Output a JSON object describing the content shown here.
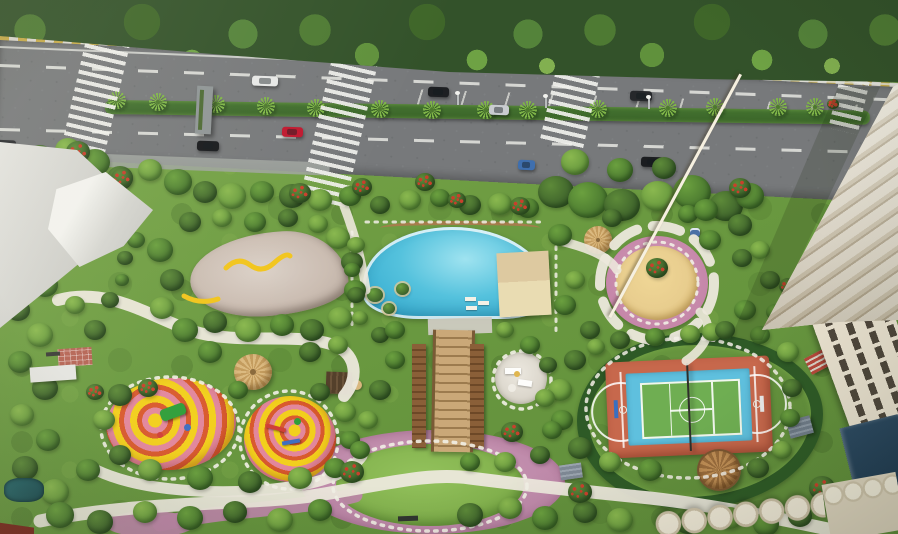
{
  "meta": {
    "title": "Aerial 3D masterplan render of residential amenity podium",
    "render_type": "architectural-visualization",
    "visible_text": "none"
  },
  "palette": {
    "canopy_base": "#33522a",
    "canopy_leaf": "#5d8a39",
    "road": "#77797b",
    "road_dark": "#646768",
    "lane_white": "#e6e7e2",
    "curb_yellow": "#d2b245",
    "median_green": "#3a6429",
    "palm_green": "#7fb548",
    "garden_light": "#79a649",
    "garden_dark": "#5f8c3a",
    "hedge_dark": "#2e5a26",
    "path_white": "#ece8dc",
    "pink_pave": "#bd87a8",
    "pool_light": "#9fe3f0",
    "pool_mid": "#55c2dd",
    "pool_deep": "#2ba4cb",
    "deck_cream": "#e9dcb2",
    "sand": "#e8cd8e",
    "swirl_yellow": "#f2cf1d",
    "swirl_pink": "#e2879c",
    "swirl_orange": "#d95a2e",
    "court_red": "#c7684c",
    "court_blue": "#5fc0de",
    "court_green": "#6fae52",
    "tower_light": "#f3edde",
    "tower_mid": "#d9cfb8",
    "tower_shadow": "#b9ac92",
    "glass_dark": "#1f3a52",
    "thatch": "#b5854f",
    "lawn": "#7fae4a",
    "flower_red": "#c8402c"
  },
  "scene": {
    "amenities": [
      "access-road",
      "palm-median",
      "zebra-crossings",
      "swimming-pool",
      "pool-deck",
      "skate-pad",
      "sand-play-circle",
      "kids-playground-swirl",
      "grand-staircase",
      "outdoor-lounge",
      "central-lawn",
      "pink-plaza",
      "multi-sport-court",
      "thatched-gazebo",
      "residential-tower",
      "entrance-plaza"
    ],
    "tree_shades": [
      [
        "#3b5f2a",
        "#5d8a39"
      ],
      [
        "#47752e",
        "#6ba03f"
      ],
      [
        "#63953c",
        "#8ab84f"
      ],
      [
        "#83b24e",
        "#a8cd6b"
      ]
    ],
    "trees": [
      [
        15,
        170,
        16,
        1
      ],
      [
        40,
        158,
        14,
        0
      ],
      [
        68,
        150,
        13,
        2
      ],
      [
        95,
        162,
        15,
        1
      ],
      [
        120,
        178,
        13,
        0
      ],
      [
        150,
        170,
        12,
        2
      ],
      [
        178,
        182,
        14,
        1
      ],
      [
        205,
        192,
        12,
        0
      ],
      [
        232,
        196,
        14,
        2
      ],
      [
        262,
        192,
        12,
        1
      ],
      [
        292,
        196,
        13,
        0
      ],
      [
        320,
        200,
        12,
        2
      ],
      [
        350,
        196,
        11,
        1
      ],
      [
        380,
        205,
        10,
        0
      ],
      [
        410,
        200,
        11,
        2
      ],
      [
        440,
        198,
        10,
        1
      ],
      [
        470,
        205,
        11,
        0
      ],
      [
        500,
        204,
        12,
        2
      ],
      [
        528,
        208,
        11,
        1
      ],
      [
        556,
        192,
        18,
        0
      ],
      [
        588,
        200,
        20,
        1
      ],
      [
        622,
        205,
        18,
        0
      ],
      [
        658,
        196,
        17,
        2
      ],
      [
        692,
        192,
        19,
        1
      ],
      [
        726,
        206,
        17,
        0
      ],
      [
        750,
        196,
        14,
        1
      ],
      [
        575,
        162,
        14,
        2
      ],
      [
        620,
        170,
        13,
        1
      ],
      [
        664,
        168,
        12,
        0
      ],
      [
        18,
        225,
        13,
        1
      ],
      [
        42,
        238,
        12,
        0
      ],
      [
        20,
        262,
        12,
        2
      ],
      [
        45,
        285,
        13,
        1
      ],
      [
        18,
        310,
        12,
        0
      ],
      [
        40,
        335,
        13,
        2
      ],
      [
        20,
        362,
        12,
        1
      ],
      [
        45,
        388,
        13,
        0
      ],
      [
        22,
        415,
        12,
        2
      ],
      [
        48,
        440,
        12,
        1
      ],
      [
        25,
        468,
        13,
        0
      ],
      [
        55,
        492,
        14,
        2
      ],
      [
        88,
        470,
        12,
        1
      ],
      [
        95,
        330,
        11,
        0
      ],
      [
        75,
        305,
        10,
        2
      ],
      [
        110,
        300,
        9,
        0
      ],
      [
        125,
        258,
        8,
        0
      ],
      [
        136,
        240,
        9,
        1
      ],
      [
        118,
        238,
        7,
        0
      ],
      [
        122,
        280,
        7,
        1
      ],
      [
        160,
        250,
        13,
        1
      ],
      [
        172,
        280,
        12,
        0
      ],
      [
        162,
        308,
        12,
        2
      ],
      [
        185,
        330,
        13,
        1
      ],
      [
        215,
        322,
        12,
        0
      ],
      [
        248,
        330,
        13,
        2
      ],
      [
        282,
        325,
        12,
        1
      ],
      [
        312,
        330,
        12,
        0
      ],
      [
        340,
        318,
        12,
        2
      ],
      [
        355,
        290,
        11,
        1
      ],
      [
        352,
        262,
        11,
        0
      ],
      [
        338,
        238,
        12,
        2
      ],
      [
        210,
        352,
        12,
        1
      ],
      [
        310,
        352,
        11,
        0
      ],
      [
        338,
        345,
        10,
        2
      ],
      [
        190,
        222,
        11,
        0
      ],
      [
        222,
        218,
        10,
        2
      ],
      [
        255,
        222,
        11,
        1
      ],
      [
        288,
        218,
        10,
        0
      ],
      [
        318,
        224,
        10,
        2
      ],
      [
        120,
        395,
        12,
        0
      ],
      [
        104,
        420,
        11,
        2
      ],
      [
        238,
        390,
        10,
        1
      ],
      [
        320,
        392,
        10,
        0
      ],
      [
        345,
        412,
        11,
        2
      ],
      [
        350,
        440,
        10,
        1
      ],
      [
        120,
        455,
        11,
        0
      ],
      [
        150,
        470,
        12,
        2
      ],
      [
        200,
        478,
        13,
        1
      ],
      [
        250,
        482,
        12,
        0
      ],
      [
        300,
        478,
        12,
        2
      ],
      [
        335,
        468,
        11,
        1
      ],
      [
        60,
        515,
        14,
        1
      ],
      [
        100,
        522,
        13,
        0
      ],
      [
        145,
        512,
        12,
        2
      ],
      [
        190,
        518,
        13,
        1
      ],
      [
        235,
        512,
        12,
        0
      ],
      [
        280,
        520,
        13,
        2
      ],
      [
        320,
        510,
        12,
        1
      ],
      [
        470,
        515,
        13,
        0
      ],
      [
        510,
        508,
        12,
        2
      ],
      [
        545,
        518,
        13,
        1
      ],
      [
        585,
        512,
        12,
        0
      ],
      [
        620,
        520,
        13,
        2
      ],
      [
        688,
        522,
        13,
        0
      ],
      [
        730,
        518,
        12,
        2
      ],
      [
        766,
        524,
        13,
        1
      ],
      [
        800,
        516,
        12,
        0
      ],
      [
        356,
        245,
        9,
        2
      ],
      [
        352,
        270,
        8,
        1
      ],
      [
        356,
        295,
        9,
        0
      ],
      [
        360,
        318,
        8,
        2
      ],
      [
        380,
        335,
        9,
        0
      ],
      [
        395,
        330,
        10,
        1
      ],
      [
        560,
        235,
        12,
        1
      ],
      [
        575,
        280,
        10,
        2
      ],
      [
        565,
        305,
        11,
        1
      ],
      [
        590,
        330,
        10,
        0
      ],
      [
        710,
        240,
        11,
        1
      ],
      [
        740,
        225,
        12,
        0
      ],
      [
        712,
        332,
        10,
        2
      ],
      [
        745,
        310,
        11,
        1
      ],
      [
        770,
        280,
        10,
        0
      ],
      [
        760,
        250,
        10,
        2
      ],
      [
        612,
        218,
        10,
        0
      ],
      [
        688,
        214,
        10,
        1
      ],
      [
        575,
        360,
        11,
        0
      ],
      [
        560,
        390,
        12,
        2
      ],
      [
        562,
        420,
        11,
        1
      ],
      [
        580,
        448,
        12,
        0
      ],
      [
        610,
        462,
        11,
        2
      ],
      [
        650,
        470,
        12,
        1
      ],
      [
        758,
        468,
        11,
        0
      ],
      [
        782,
        450,
        10,
        2
      ],
      [
        790,
        418,
        10,
        1
      ],
      [
        792,
        388,
        10,
        0
      ],
      [
        788,
        352,
        11,
        2
      ],
      [
        760,
        335,
        10,
        1
      ],
      [
        725,
        330,
        10,
        0
      ],
      [
        690,
        334,
        10,
        2
      ],
      [
        655,
        337,
        10,
        1
      ],
      [
        620,
        340,
        10,
        0
      ],
      [
        596,
        347,
        9,
        2
      ],
      [
        395,
        360,
        10,
        1
      ],
      [
        380,
        390,
        11,
        0
      ],
      [
        368,
        420,
        10,
        2
      ],
      [
        360,
        450,
        10,
        1
      ],
      [
        505,
        330,
        9,
        2
      ],
      [
        530,
        345,
        10,
        1
      ],
      [
        548,
        365,
        9,
        0
      ],
      [
        545,
        398,
        10,
        2
      ],
      [
        552,
        430,
        10,
        1
      ],
      [
        540,
        455,
        10,
        0
      ],
      [
        505,
        462,
        11,
        2
      ],
      [
        470,
        462,
        10,
        1
      ],
      [
        706,
        210,
        12,
        1
      ],
      [
        742,
        258,
        10,
        0
      ],
      [
        775,
        312,
        9,
        1
      ]
    ],
    "flower_trees": [
      [
        32,
        165,
        13
      ],
      [
        78,
        152,
        12
      ],
      [
        122,
        178,
        11
      ],
      [
        300,
        193,
        11
      ],
      [
        362,
        187,
        10
      ],
      [
        425,
        182,
        10
      ],
      [
        457,
        200,
        9
      ],
      [
        520,
        206,
        10
      ],
      [
        740,
        188,
        11
      ],
      [
        352,
        472,
        12
      ],
      [
        512,
        432,
        11
      ],
      [
        580,
        492,
        12
      ],
      [
        822,
        488,
        13
      ],
      [
        148,
        388,
        10
      ],
      [
        788,
        286,
        9
      ],
      [
        95,
        392,
        9
      ],
      [
        833,
        104,
        6
      ],
      [
        657,
        268,
        11
      ]
    ],
    "median_palms": [
      [
        117,
        100
      ],
      [
        158,
        102
      ],
      [
        216,
        104
      ],
      [
        266,
        106
      ],
      [
        316,
        108
      ],
      [
        380,
        109
      ],
      [
        432,
        110
      ],
      [
        486,
        110
      ],
      [
        528,
        110
      ],
      [
        598,
        109
      ],
      [
        668,
        108
      ],
      [
        715,
        107
      ],
      [
        778,
        107
      ],
      [
        815,
        107
      ]
    ],
    "canopy_palms": [
      [
        95,
        14
      ],
      [
        300,
        10
      ],
      [
        498,
        18
      ],
      [
        640,
        6
      ],
      [
        760,
        30
      ],
      [
        843,
        52
      ]
    ],
    "cars": [
      {
        "x": 252,
        "y": 76,
        "w": 26,
        "c": "#e6e7e6"
      },
      {
        "x": 428,
        "y": 87,
        "w": 21,
        "c": "#1d1f22"
      },
      {
        "x": 630,
        "y": 91,
        "w": 22,
        "c": "#26282b"
      },
      {
        "x": 489,
        "y": 105,
        "w": 20,
        "c": "#c9ccd0"
      },
      {
        "x": 282,
        "y": 127,
        "w": 21,
        "c": "#c0182f"
      },
      {
        "x": 197,
        "y": 141,
        "w": 22,
        "c": "#17191c"
      },
      {
        "x": 518,
        "y": 160,
        "w": 17,
        "c": "#3f6fae"
      },
      {
        "x": 641,
        "y": 157,
        "w": 23,
        "c": "#1b1d20"
      },
      {
        "x": -8,
        "y": 140,
        "w": 24,
        "c": "#2a2c30"
      }
    ],
    "crosswalks": [
      {
        "x": 74,
        "y": 38,
        "w": 44,
        "h": 112
      },
      {
        "x": 316,
        "y": 56,
        "w": 46,
        "h": 148
      },
      {
        "x": 548,
        "y": 68,
        "w": 44,
        "h": 78
      },
      {
        "x": 834,
        "y": 78,
        "w": 30,
        "h": 54
      }
    ],
    "light_poles": [
      [
        457,
        94
      ],
      [
        545,
        97
      ],
      [
        648,
        98
      ]
    ]
  }
}
